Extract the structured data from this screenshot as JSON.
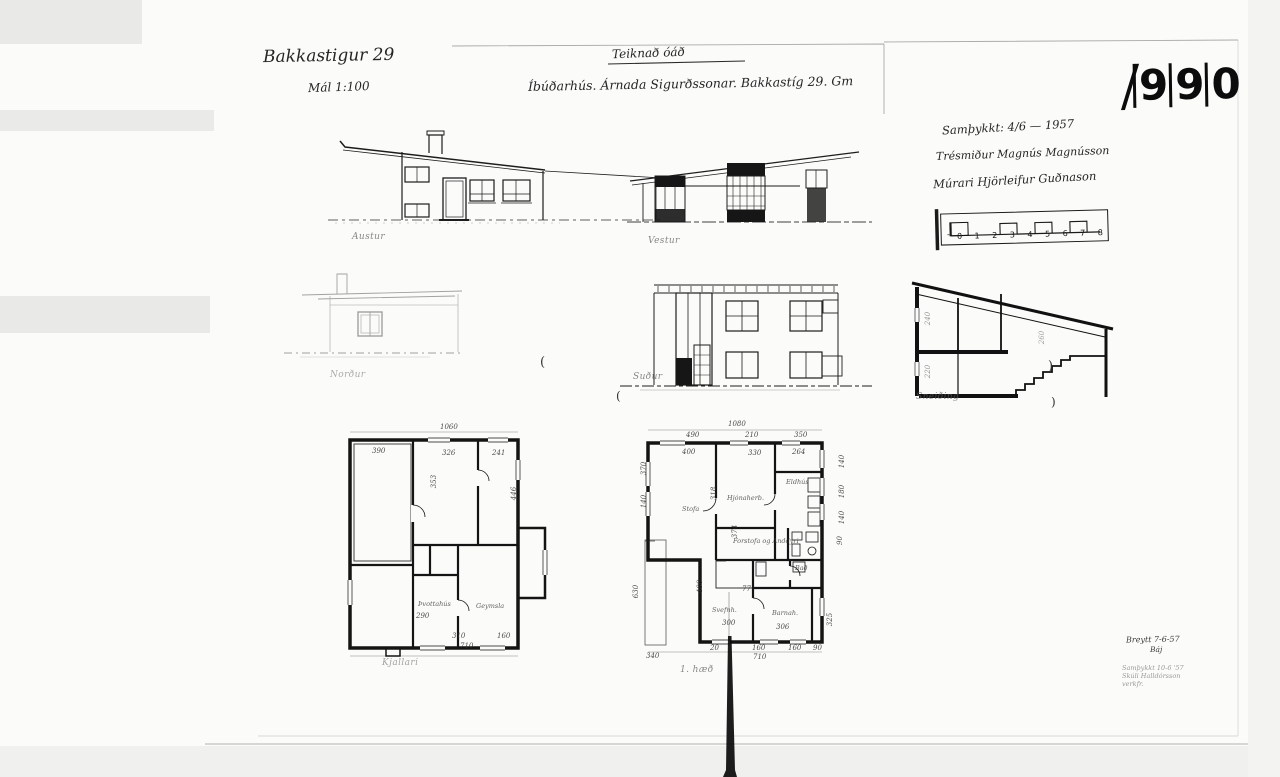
{
  "page": {
    "stamp": {
      "digits": [
        "9",
        "9",
        "0"
      ]
    },
    "header": {
      "address": "Bakkastigur 29",
      "scale": "Mál 1:100",
      "drawn_note": "Teiknað óáð",
      "subtitle": "Íbúðarhús. Árnada Sigurðssonar. Bakkastíg 29. Gm"
    },
    "approval_block": {
      "approved": "Samþykkt: 4/6 — 1957",
      "carpenter": "Trésmiður Magnús Magnússon",
      "mason": "Múrari Hjörleifur Guðnason"
    },
    "revision_block": {
      "changed": "Breytt 7-6-57",
      "initials": "Báj",
      "note1": "Samþykkt 10-6 '57",
      "note2": "Skúli Halldórsson",
      "note3": "verkfr."
    }
  },
  "captions": {
    "east": "Austur",
    "west": "Vestur",
    "north": "Norður",
    "south": "Suður",
    "section": "Sneiðing",
    "basement": "Kjallari",
    "first_floor": "1. hæð"
  },
  "scale_bar": {
    "minus": "-",
    "ticks": [
      "0",
      "1",
      "2",
      "3",
      "4",
      "5",
      "6",
      "7",
      "8"
    ]
  },
  "stray_marks": [
    {
      "t": "(",
      "x": 540,
      "y": 356,
      "s": 13
    },
    {
      "t": "(",
      "x": 616,
      "y": 390,
      "s": 12
    },
    {
      "t": ")",
      "x": 1048,
      "y": 360,
      "s": 13
    },
    {
      "t": ")",
      "x": 1051,
      "y": 396,
      "s": 12
    }
  ],
  "basement_plan": {
    "dims": [
      {
        "t": "1060",
        "x": 440,
        "y": 424
      },
      {
        "t": "390",
        "x": 372,
        "y": 448
      },
      {
        "t": "326",
        "x": 442,
        "y": 450
      },
      {
        "t": "241",
        "x": 492,
        "y": 450
      },
      {
        "t": "353",
        "x": 428,
        "y": 478,
        "r": -90
      },
      {
        "t": "446",
        "x": 508,
        "y": 490,
        "r": -90
      },
      {
        "t": "290",
        "x": 416,
        "y": 613
      },
      {
        "t": "310",
        "x": 452,
        "y": 633
      },
      {
        "t": "160",
        "x": 497,
        "y": 633
      },
      {
        "t": "710",
        "x": 460,
        "y": 643
      }
    ],
    "rooms": [
      {
        "t": "Þvottahús",
        "x": 418,
        "y": 601
      },
      {
        "t": "Geymsla",
        "x": 476,
        "y": 603
      }
    ]
  },
  "first_floor_plan": {
    "dims": [
      {
        "t": "1080",
        "x": 728,
        "y": 421
      },
      {
        "t": "490",
        "x": 686,
        "y": 432
      },
      {
        "t": "210",
        "x": 745,
        "y": 432
      },
      {
        "t": "350",
        "x": 794,
        "y": 432
      },
      {
        "t": "400",
        "x": 682,
        "y": 449
      },
      {
        "t": "330",
        "x": 748,
        "y": 450
      },
      {
        "t": "264",
        "x": 792,
        "y": 449
      },
      {
        "t": "318",
        "x": 708,
        "y": 490,
        "r": -90
      },
      {
        "t": "374",
        "x": 729,
        "y": 528,
        "r": -90
      },
      {
        "t": "370",
        "x": 638,
        "y": 465,
        "r": -90
      },
      {
        "t": "140",
        "x": 638,
        "y": 498,
        "r": -90
      },
      {
        "t": "630",
        "x": 630,
        "y": 588,
        "r": -90
      },
      {
        "t": "140",
        "x": 836,
        "y": 458,
        "r": -90
      },
      {
        "t": "180",
        "x": 836,
        "y": 488,
        "r": -90
      },
      {
        "t": "140",
        "x": 836,
        "y": 514,
        "r": -90
      },
      {
        "t": "90",
        "x": 836,
        "y": 537,
        "r": -90
      },
      {
        "t": "325",
        "x": 824,
        "y": 616,
        "r": -90
      },
      {
        "t": "400",
        "x": 694,
        "y": 583,
        "r": -90
      },
      {
        "t": "77",
        "x": 742,
        "y": 586
      },
      {
        "t": "300",
        "x": 722,
        "y": 620
      },
      {
        "t": "306",
        "x": 776,
        "y": 624
      },
      {
        "t": "340",
        "x": 646,
        "y": 653
      },
      {
        "t": "20",
        "x": 710,
        "y": 645
      },
      {
        "t": "160",
        "x": 752,
        "y": 645
      },
      {
        "t": "160",
        "x": 788,
        "y": 645
      },
      {
        "t": "90",
        "x": 813,
        "y": 645
      },
      {
        "t": "710",
        "x": 753,
        "y": 654
      }
    ],
    "rooms": [
      {
        "t": "Stofa",
        "x": 682,
        "y": 506
      },
      {
        "t": "Hjónaherb.",
        "x": 727,
        "y": 495
      },
      {
        "t": "Eldhús",
        "x": 786,
        "y": 479
      },
      {
        "t": "Forstofa og Anddyri",
        "x": 733,
        "y": 538
      },
      {
        "t": "Svefnh.",
        "x": 712,
        "y": 607
      },
      {
        "t": "Barnah.",
        "x": 772,
        "y": 610
      },
      {
        "t": "Bað",
        "x": 795,
        "y": 565
      }
    ]
  },
  "section_drawing": {
    "dims": [
      {
        "t": "240",
        "x": 922,
        "y": 315,
        "r": -90,
        "o": 0.5
      },
      {
        "t": "220",
        "x": 922,
        "y": 368,
        "r": -90,
        "o": 0.5
      },
      {
        "t": "260",
        "x": 1036,
        "y": 334,
        "r": -90,
        "o": 0.45
      }
    ]
  }
}
